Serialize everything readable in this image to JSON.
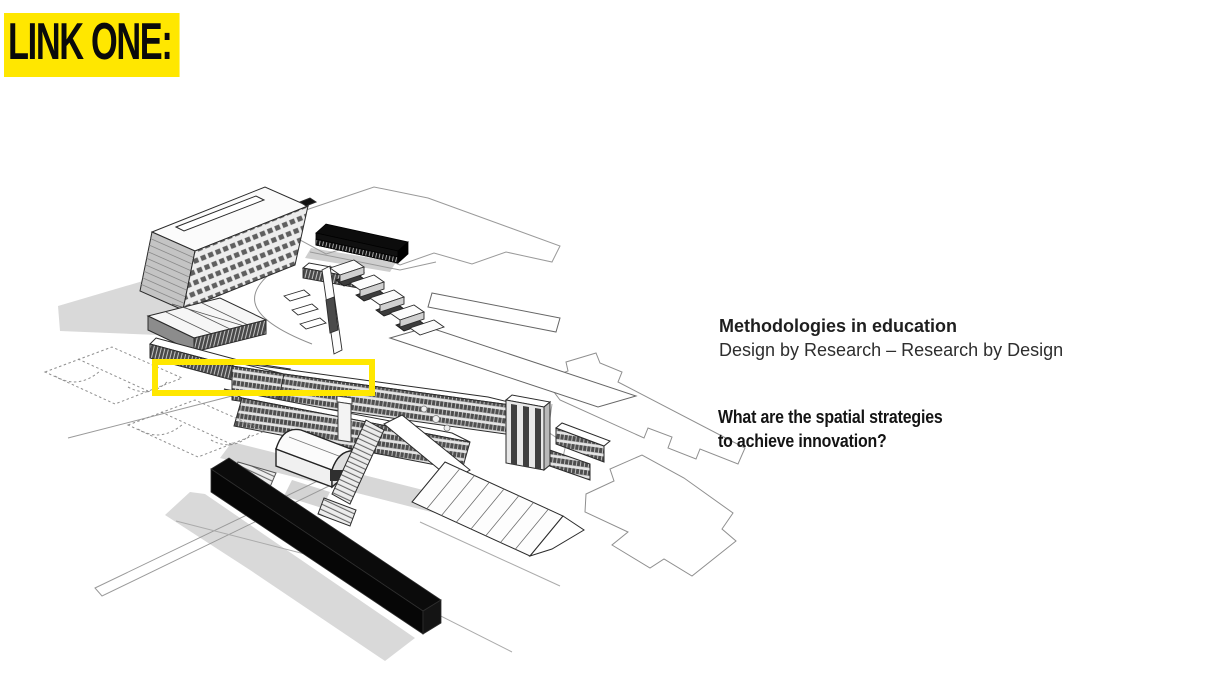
{
  "slide": {
    "tag_label": "LINK ONE:",
    "heading": {
      "title": "Methodologies in education",
      "subtitle": "Design by Research – Research by Design"
    },
    "question": {
      "line1": "What are the spatial strategies",
      "line2": "to achieve innovation?"
    },
    "figure": {
      "label": "campus-axonometric-drawing",
      "highlight_color": "#FFE700"
    },
    "colors": {
      "highlight_yellow": "#FFE700",
      "shadow_gray": "#D9D9D9",
      "black_mass": "#0B0B0B",
      "line": "#2B2B2B"
    }
  }
}
